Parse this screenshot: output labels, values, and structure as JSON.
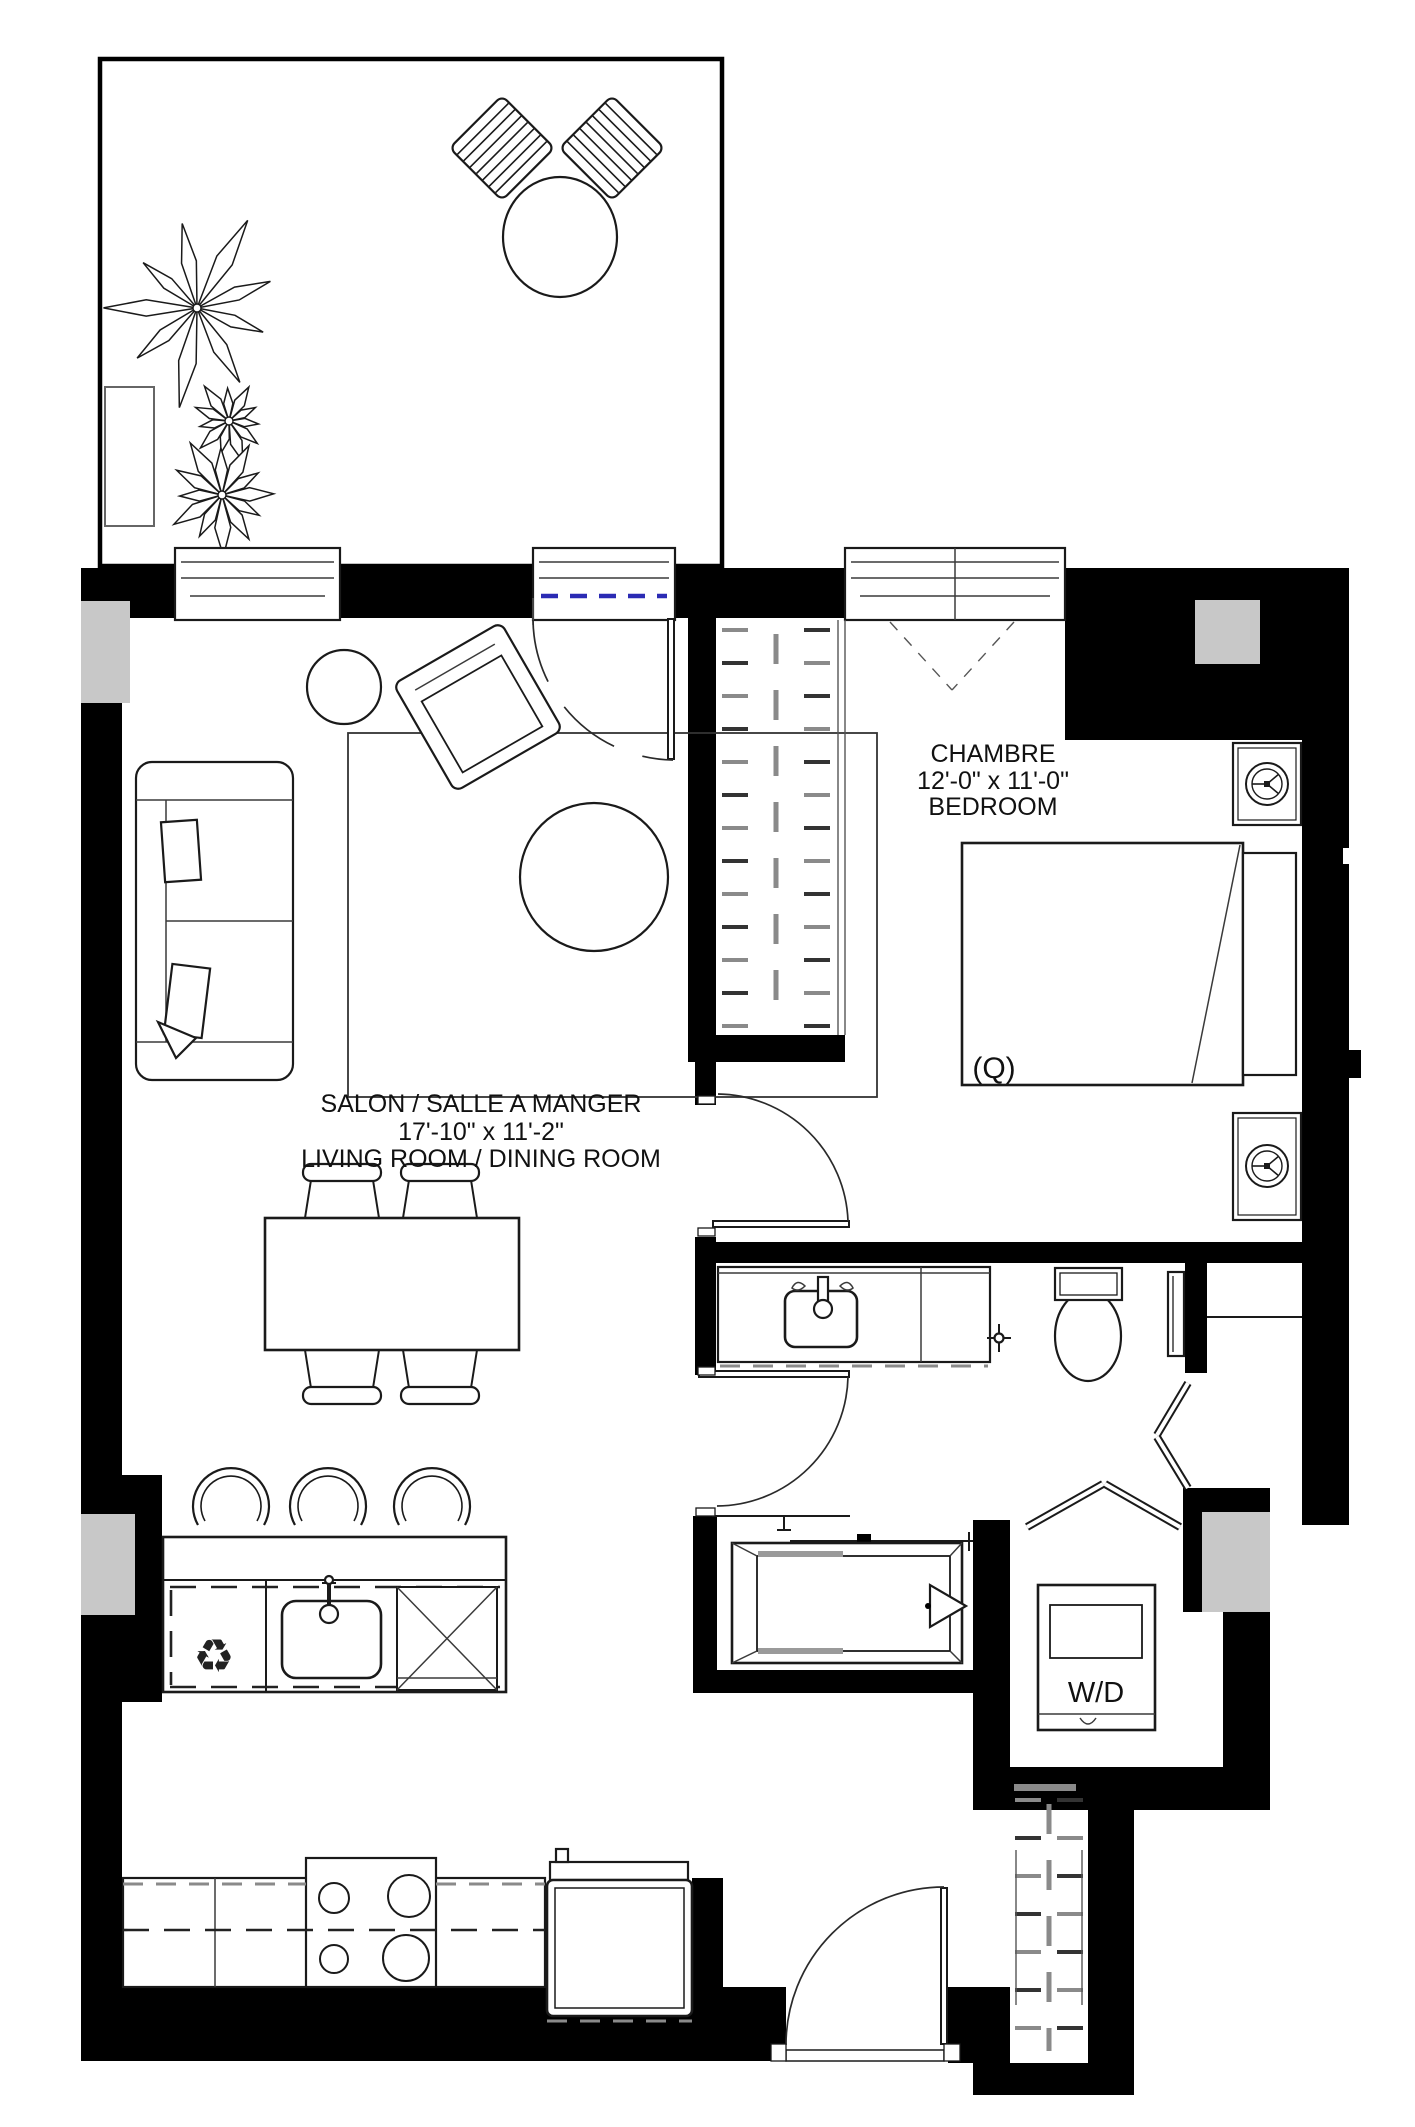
{
  "plan": {
    "rooms": {
      "living": {
        "line1": "SALON / SALLE A MANGER",
        "line2": "17'-10\" x 11'-2\"",
        "line3": "LIVING ROOM / DINING ROOM"
      },
      "bedroom": {
        "line1": "CHAMBRE",
        "line2": "12'-0\" x 11'-0\"",
        "line3": "BEDROOM"
      }
    },
    "labels": {
      "bed_size": "(Q)",
      "washer_dryer": "W/D"
    },
    "icons": {
      "recycle_symbol": "♻"
    },
    "colors": {
      "wall": "#000000",
      "line": "#1a1a1a",
      "structural_column_gray": "#c8c8c8",
      "hatch_gray": "#8a8a8a",
      "patio_threshold_blue": "#2b2bb4",
      "background": "#ffffff"
    }
  }
}
